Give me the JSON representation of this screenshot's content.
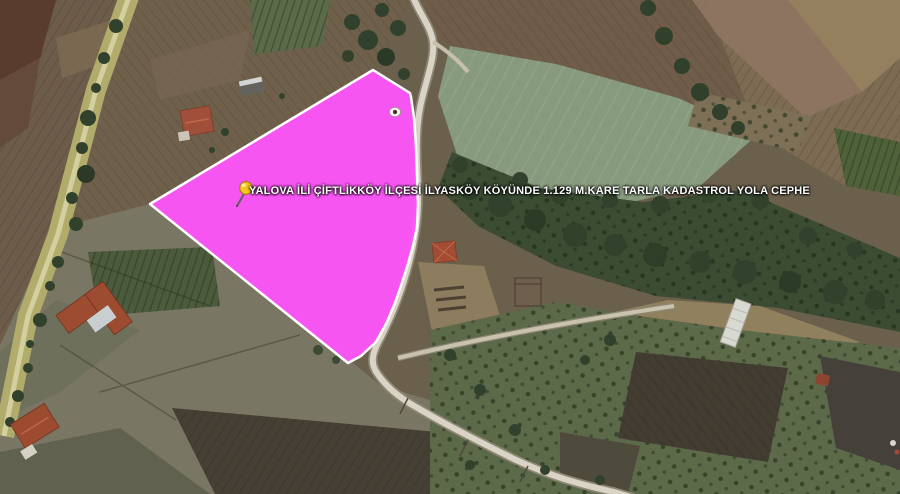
{
  "map": {
    "view": "satellite-imagery",
    "parcel_overlay": {
      "label": "YALOVA İLİ ÇİFTLİKKÖY İLÇESİ İLYASKÖY KÖYÜNDE 1.129 M.KARE TARLA KADASTROL YOLA CEPHE",
      "fill_color": "#fb55f7",
      "border_color": "#ffffff",
      "label_color": "#ffffff"
    },
    "icons": {
      "pushpin": "yellow-pushpin-icon",
      "pushpin_color": "#f3c81a",
      "placemark_dot": "placemark-dot-icon"
    }
  }
}
